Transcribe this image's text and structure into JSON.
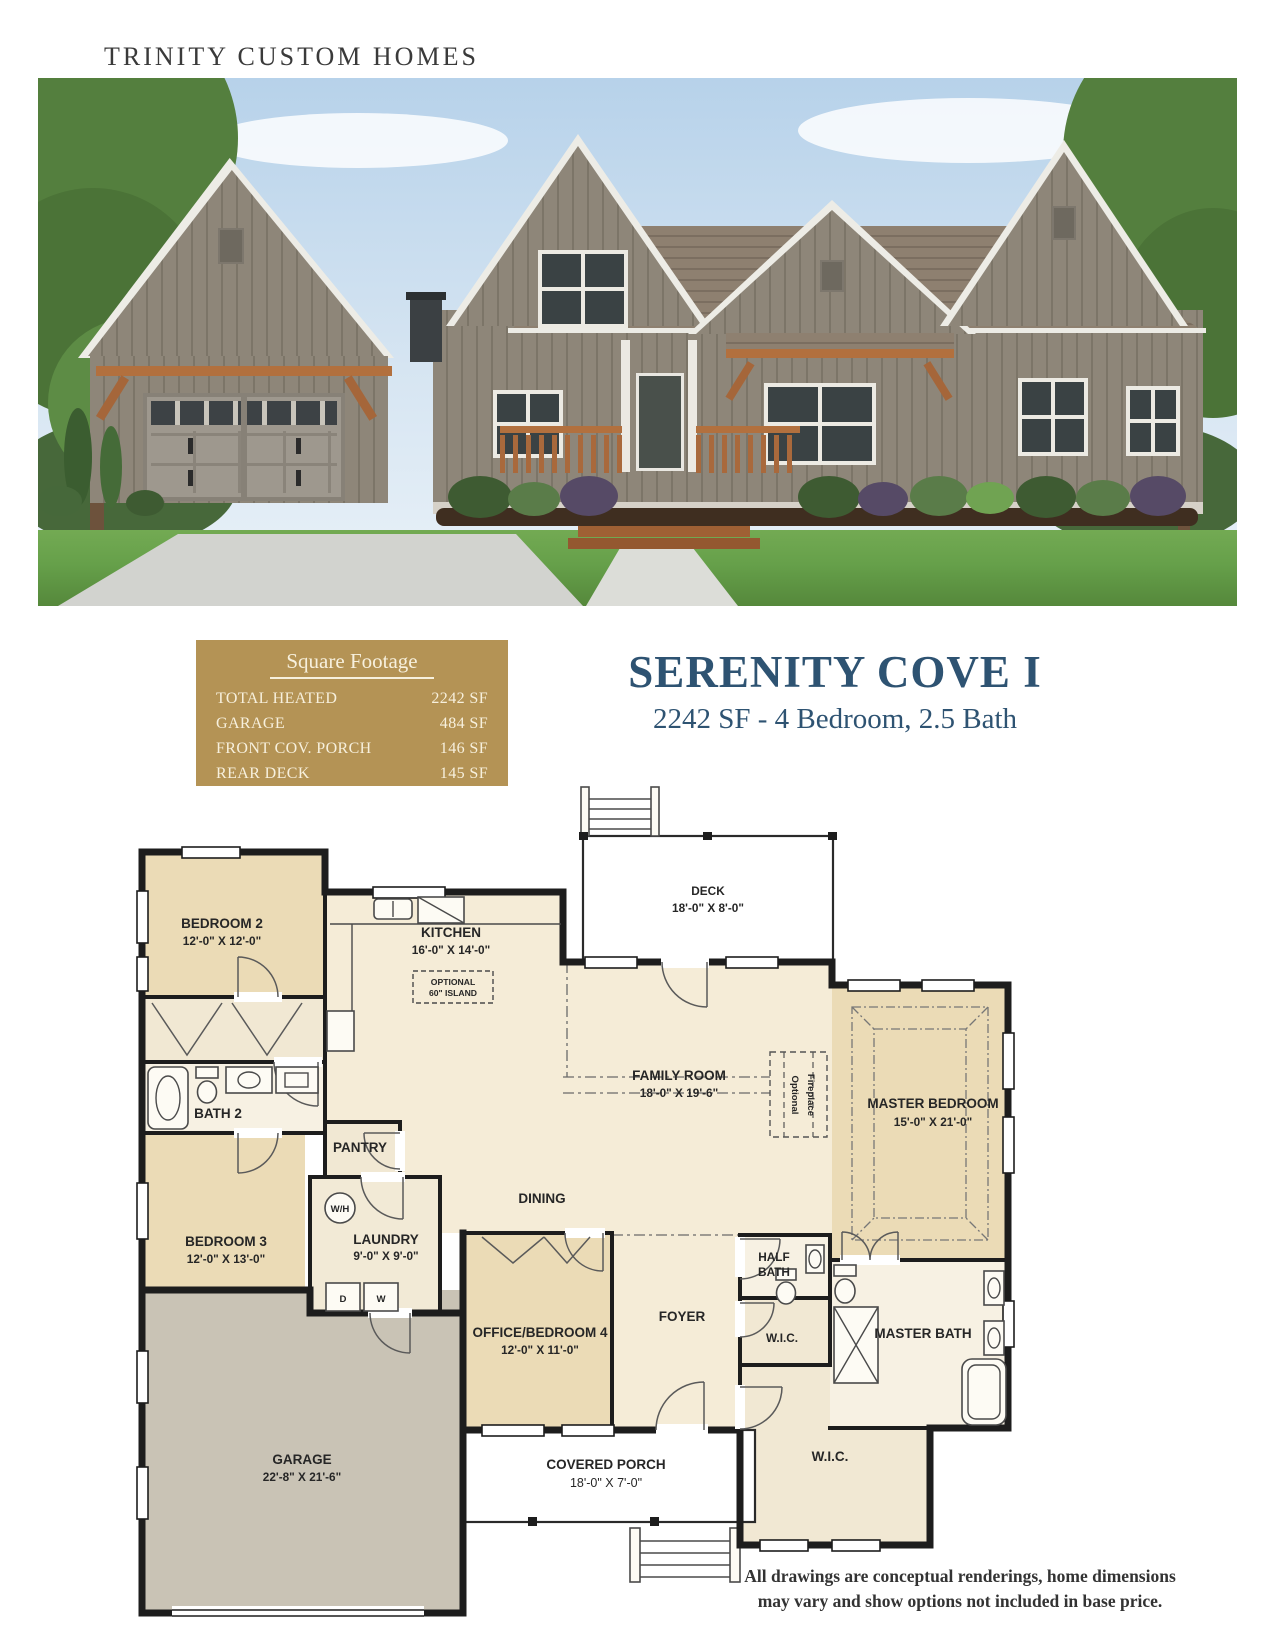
{
  "brand": "TRINITY CUSTOM HOMES",
  "title": {
    "name": "SERENITY COVE I",
    "subtitle": "2242 SF - 4 Bedroom, 2.5 Bath"
  },
  "square_footage": {
    "heading": "Square Footage",
    "rows": [
      {
        "label": "TOTAL HEATED",
        "value": "2242 SF"
      },
      {
        "label": "GARAGE",
        "value": "484 SF"
      },
      {
        "label": "FRONT COV. PORCH",
        "value": "146 SF"
      },
      {
        "label": "REAR DECK",
        "value": "145 SF"
      }
    ]
  },
  "plan": {
    "deck": {
      "name": "DECK",
      "dims": "18'-0\" X 8'-0\""
    },
    "kitchen": {
      "name": "KITCHEN",
      "dims": "16'-0\" X 14'-0\""
    },
    "island": {
      "line1": "OPTIONAL",
      "line2": "60\" ISLAND"
    },
    "bedroom2": {
      "name": "BEDROOM 2",
      "dims": "12'-0\" X 12'-0\""
    },
    "bath2": {
      "name": "BATH 2"
    },
    "bedroom3": {
      "name": "BEDROOM 3",
      "dims": "12'-0\" X 13'-0\""
    },
    "pantry": {
      "name": "PANTRY"
    },
    "laundry": {
      "name": "LAUNDRY",
      "dims": "9'-0\" X 9'-0\""
    },
    "dining": {
      "name": "DINING"
    },
    "family": {
      "name": "FAMILY ROOM",
      "dims": "18'-0\" X 19'-6\""
    },
    "fireplace": {
      "line1": "Optional",
      "line2": "Fireplace"
    },
    "master_bedroom": {
      "name": "MASTER BEDROOM",
      "dims": "15'-0\" X 21'-0\""
    },
    "master_bath": {
      "name": "MASTER BATH"
    },
    "half_bath": {
      "line1": "HALF",
      "line2": "BATH"
    },
    "wic_small": {
      "name": "W.I.C."
    },
    "wic_large": {
      "name": "W.I.C."
    },
    "office": {
      "name": "OFFICE/BEDROOM 4",
      "dims": "12'-0\" X 11'-0\""
    },
    "foyer": {
      "name": "FOYER"
    },
    "garage": {
      "name": "GARAGE",
      "dims": "22'-8\" X 21'-6\""
    },
    "porch": {
      "name": "COVERED PORCH",
      "dims": "18'-0\" X 7'-0\""
    },
    "appliances": {
      "water_heater": "W/H",
      "dryer": "D",
      "washer": "W"
    }
  },
  "disclaimer": {
    "line1": "All drawings are conceptual renderings, home dimensions",
    "line2": "may vary and show options not included in base price."
  },
  "colors": {
    "gold": "#b49355",
    "navy": "#2e5372",
    "wall": "#1d1d1d",
    "room_tan": "#ebdbb6",
    "room_cream": "#f5ecd7",
    "garage_gray": "#c9c3b5"
  }
}
